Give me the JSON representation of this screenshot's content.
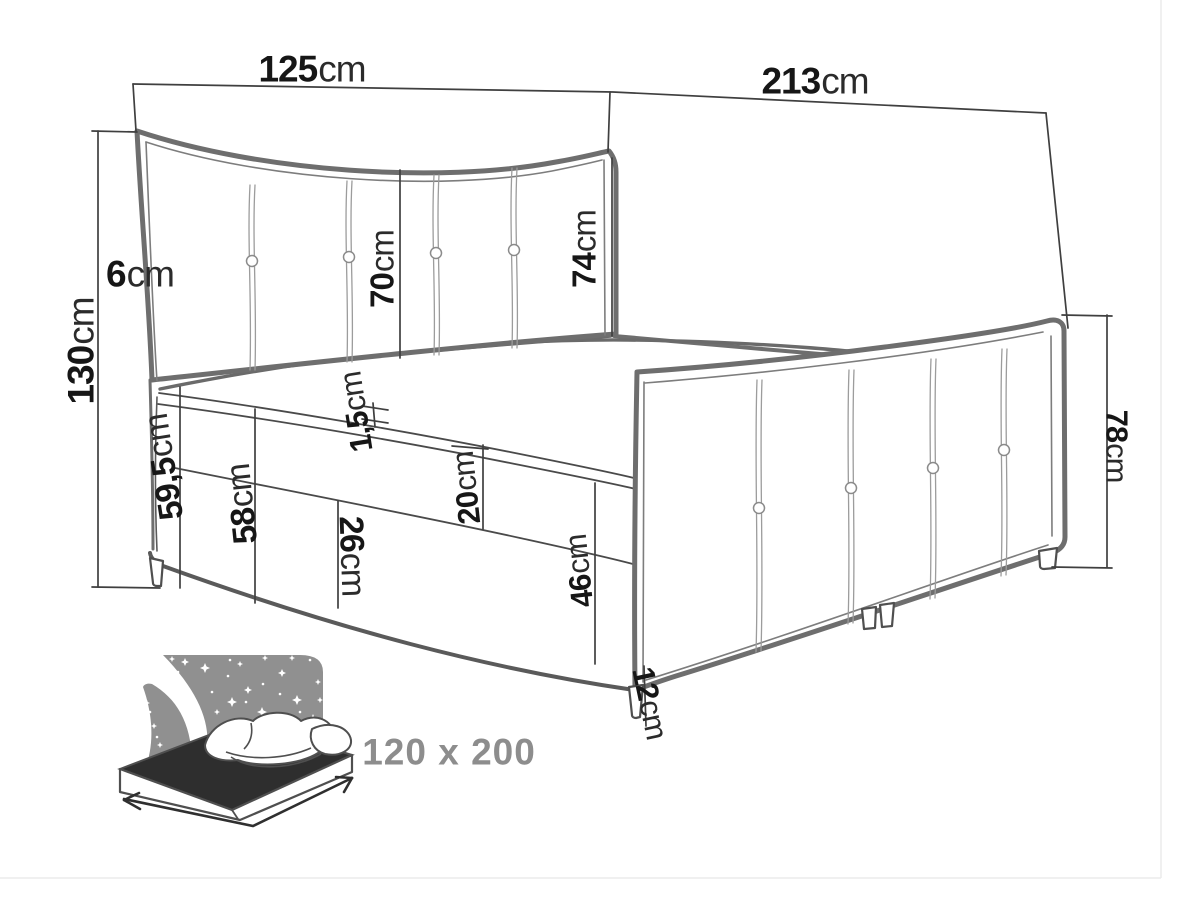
{
  "diagram": {
    "dimensions": {
      "headboard_width": {
        "value": "125",
        "unit": "cm"
      },
      "bed_length": {
        "value": "213",
        "unit": "cm"
      },
      "headboard_height": {
        "value": "130",
        "unit": "cm"
      },
      "headboard_frame_depth": {
        "value": "6",
        "unit": "cm"
      },
      "headboard_panel": {
        "value": "70",
        "unit": "cm"
      },
      "headboard_inner": {
        "value": "74",
        "unit": "cm"
      },
      "welt_strip": {
        "value": "1,5",
        "unit": "cm"
      },
      "side_height_head_end": {
        "value": "59,5",
        "unit": "cm"
      },
      "base_side_height": {
        "value": "58",
        "unit": "cm"
      },
      "lower_base_section": {
        "value": "26",
        "unit": "cm"
      },
      "upper_base_section": {
        "value": "20",
        "unit": "cm"
      },
      "base_front_height": {
        "value": "46",
        "unit": "cm"
      },
      "leg_height": {
        "value": "12",
        "unit": "cm"
      },
      "footboard_height": {
        "value": "78",
        "unit": "cm"
      }
    },
    "size_badge": {
      "label": "120 x 200"
    },
    "colors": {
      "line": "#3f3f3f",
      "outline": "#6e6e6e",
      "stitch": "#9c9c9c",
      "label_number": "#161616",
      "label_unit": "#2b2b2b",
      "badge_text": "#8d8d8d",
      "icon_gray": "#909090",
      "icon_dark": "#2e2e2e",
      "background": "#ffffff"
    }
  }
}
